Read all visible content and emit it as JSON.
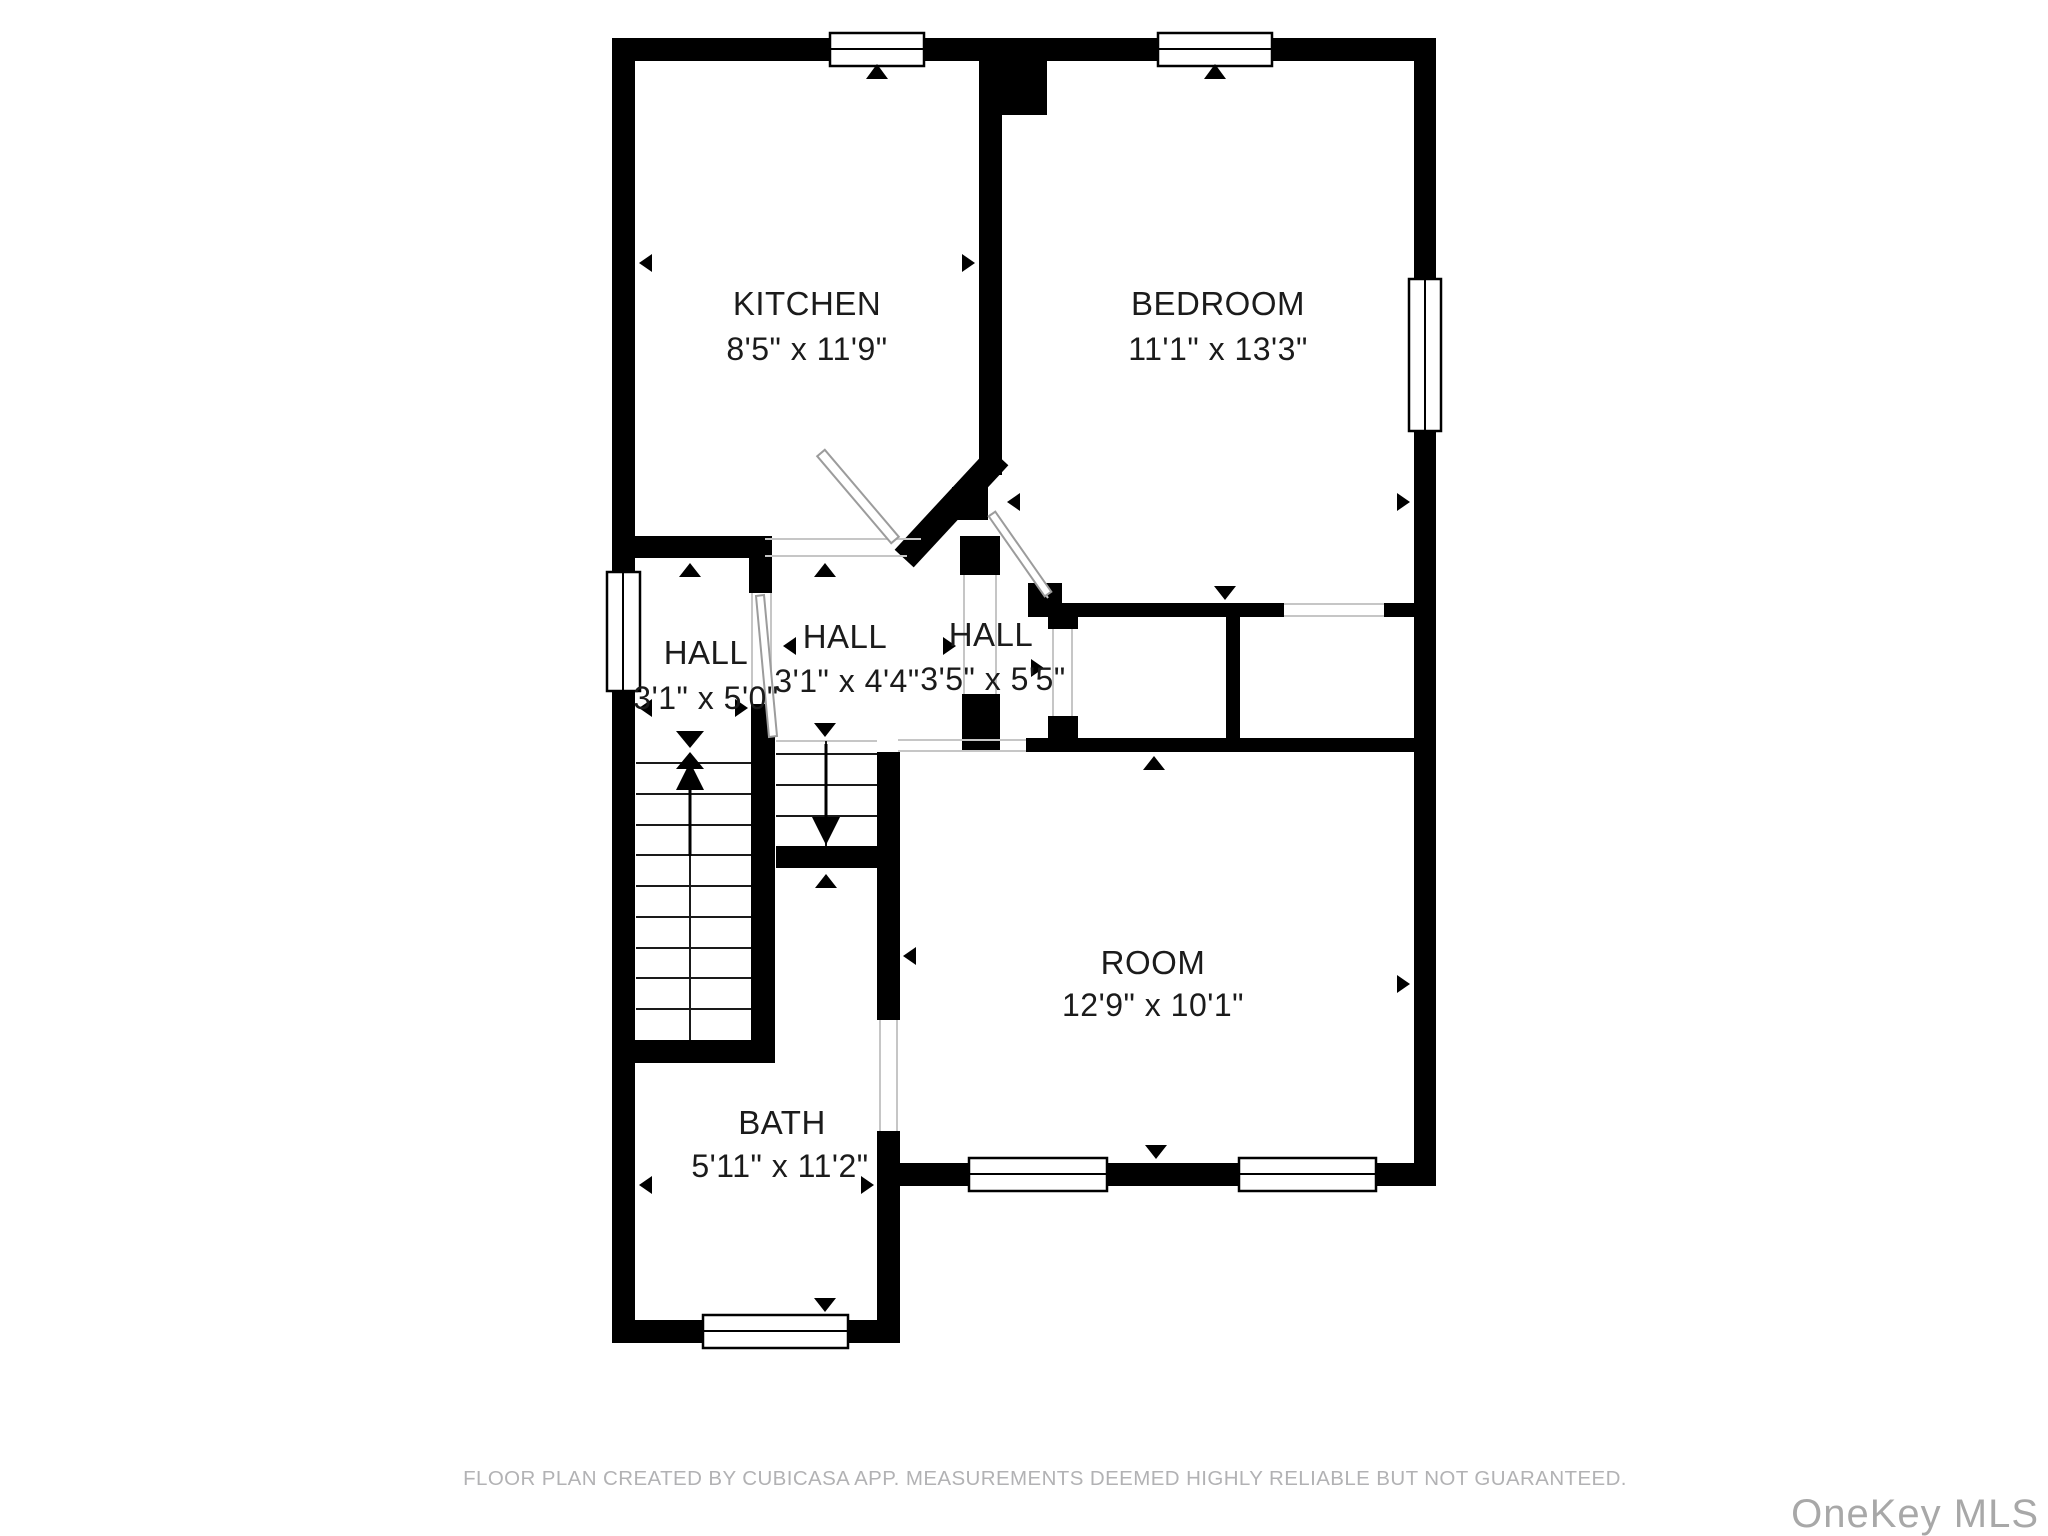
{
  "colors": {
    "wall": "#000000",
    "label_text": "#1b1b1b",
    "opening_hairline": "#c6c6c6",
    "door_leaf": "#9c9c9c",
    "footer_text": "#b2b2b4",
    "watermark_text": "#a8a8a8",
    "background": "#ffffff"
  },
  "rooms": [
    {
      "id": "kitchen",
      "name": "KITCHEN",
      "dimensions": "8'5\" x 11'9\""
    },
    {
      "id": "bedroom",
      "name": "BEDROOM",
      "dimensions": "11'1\" x 13'3\""
    },
    {
      "id": "hall-left",
      "name": "HALL",
      "dimensions": "3'1\" x 5'0\""
    },
    {
      "id": "hall-middle",
      "name": "HALL",
      "dimensions": "3'1\" x 4'4\""
    },
    {
      "id": "hall-right",
      "name": "HALL",
      "dimensions": "3'5\" x 5'5\""
    },
    {
      "id": "room",
      "name": "ROOM",
      "dimensions": "12'9\" x 10'1\""
    },
    {
      "id": "bath",
      "name": "BATH",
      "dimensions": "5'11\" x 11'2\""
    }
  ],
  "footer": {
    "text": "FLOOR PLAN CREATED BY CUBICASA APP. MEASUREMENTS DEEMED HIGHLY RELIABLE BUT NOT GUARANTEED."
  },
  "watermark": {
    "text": "OneKey MLS"
  }
}
